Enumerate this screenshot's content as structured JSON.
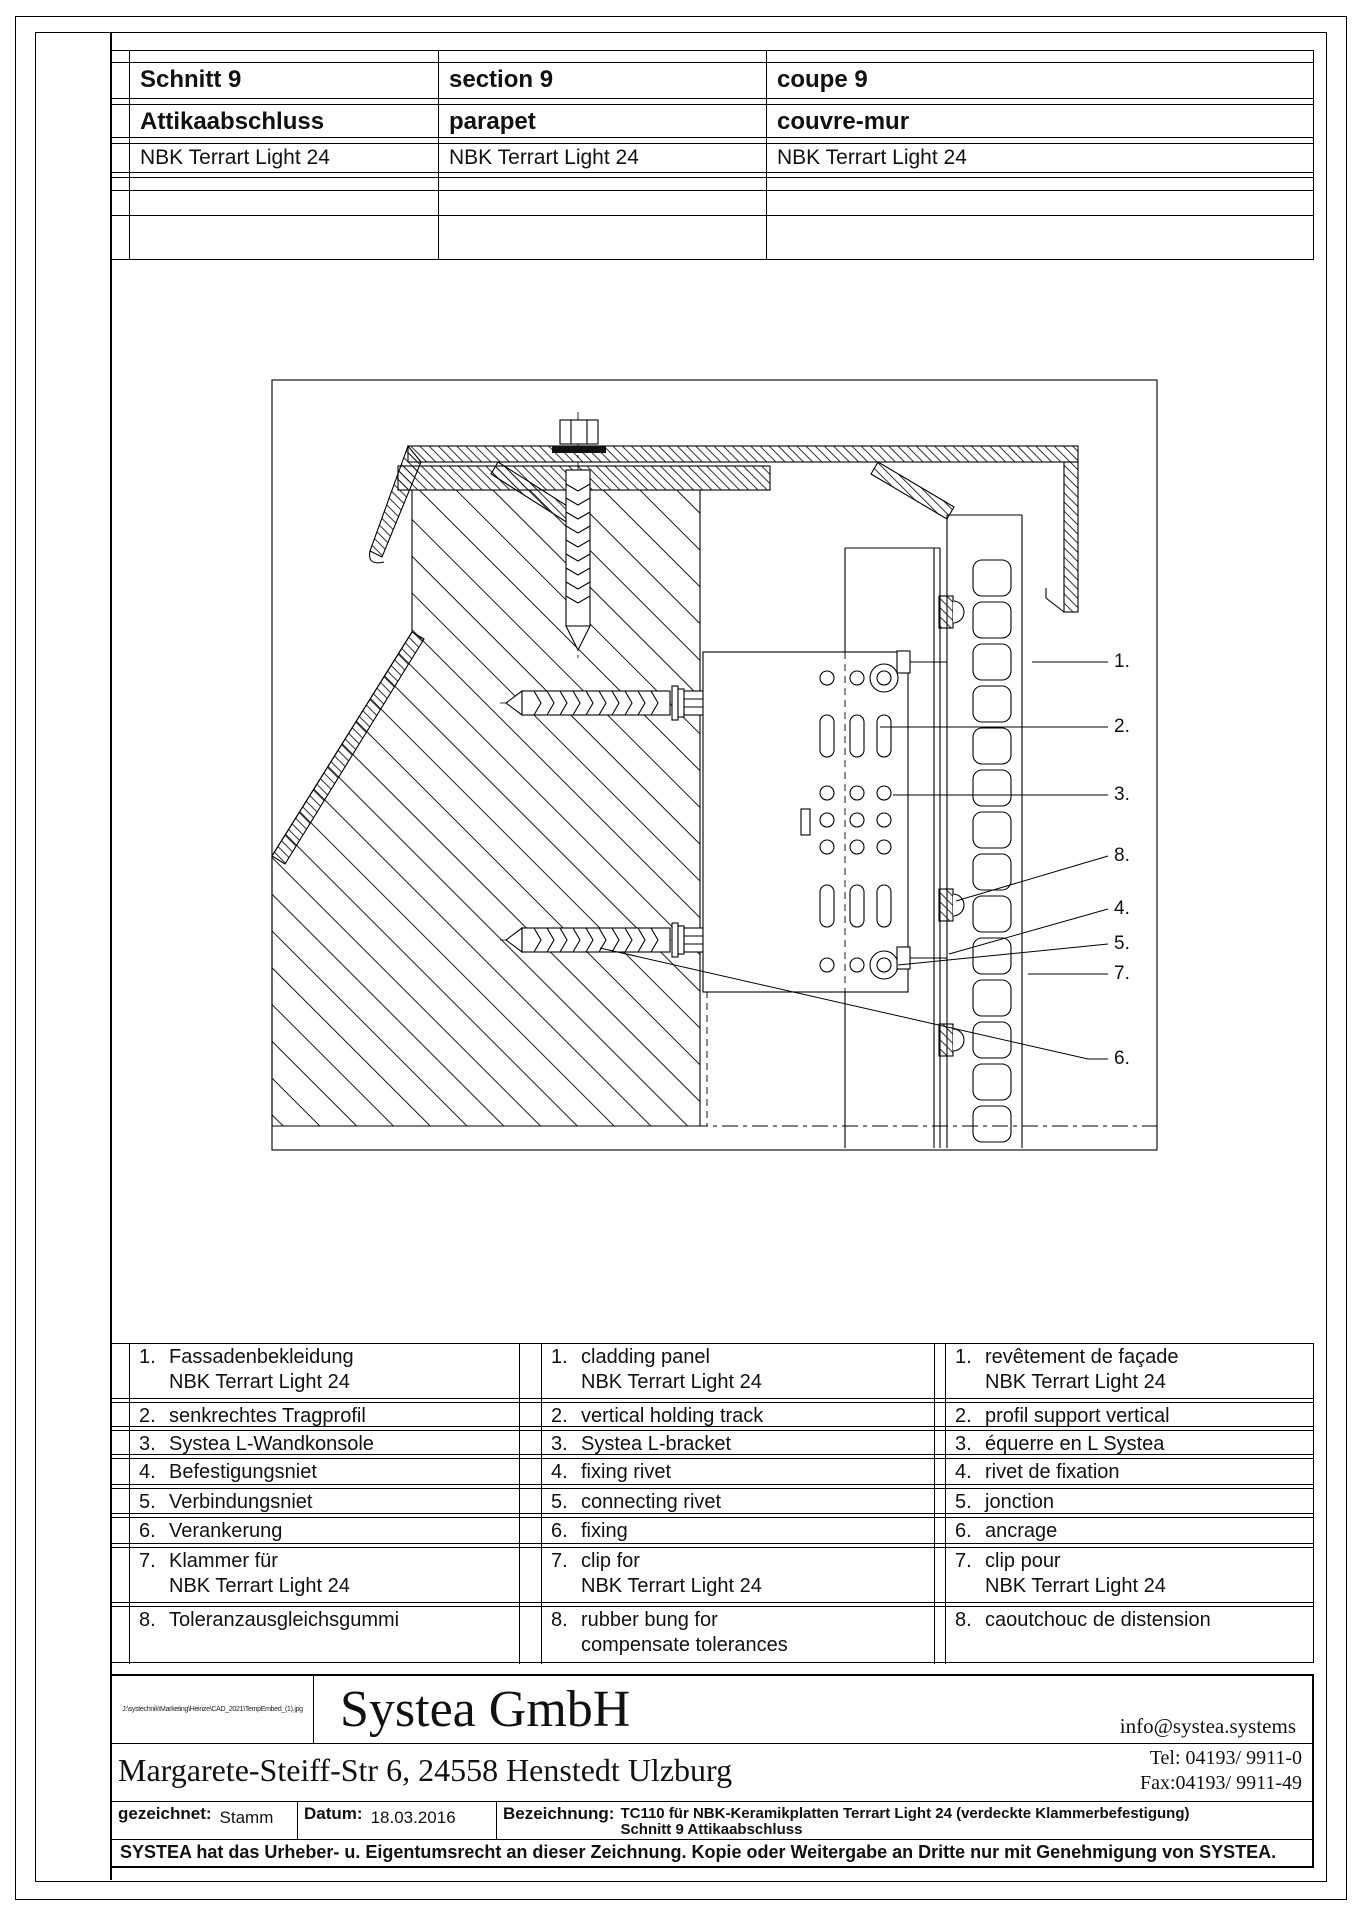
{
  "header_table": {
    "rows": [
      {
        "de": "Schnitt 9",
        "en": "section 9",
        "fr": "coupe 9"
      },
      {
        "de": "Attikaabschluss",
        "en": "parapet",
        "fr": "couvre-mur"
      },
      {
        "de": "NBK Terrart Light 24",
        "en": "NBK Terrart Light 24",
        "fr": "NBK Terrart Light 24"
      }
    ]
  },
  "callouts": [
    "1.",
    "2.",
    "3.",
    "8.",
    "4.",
    "5.",
    "7.",
    "6."
  ],
  "legend": {
    "rows": [
      {
        "num": "1.",
        "de": [
          "Fassadenbekleidung",
          "NBK Terrart Light 24"
        ],
        "en": [
          "cladding panel",
          "NBK Terrart Light 24"
        ],
        "fr": [
          "revêtement de façade",
          "NBK Terrart Light 24"
        ]
      },
      {
        "num": "2.",
        "de": [
          "senkrechtes Tragprofil"
        ],
        "en": [
          "vertical holding track"
        ],
        "fr": [
          "profil support vertical"
        ]
      },
      {
        "num": "3.",
        "de": [
          "Systea L-Wandkonsole"
        ],
        "en": [
          "Systea L-bracket"
        ],
        "fr": [
          "équerre en L Systea"
        ]
      },
      {
        "num": "4.",
        "de": [
          "Befestigungsniet"
        ],
        "en": [
          "fixing rivet"
        ],
        "fr": [
          "rivet de fixation"
        ]
      },
      {
        "num": "5.",
        "de": [
          "Verbindungsniet"
        ],
        "en": [
          "connecting rivet"
        ],
        "fr": [
          "jonction"
        ]
      },
      {
        "num": "6.",
        "de": [
          "Verankerung"
        ],
        "en": [
          "fixing"
        ],
        "fr": [
          "ancrage"
        ]
      },
      {
        "num": "7.",
        "de": [
          "Klammer für",
          "NBK Terrart Light 24"
        ],
        "en": [
          "clip for",
          "NBK Terrart Light 24"
        ],
        "fr": [
          "clip pour",
          "NBK Terrart Light 24"
        ]
      },
      {
        "num": "8.",
        "de": [
          "Toleranzausgleichsgummi"
        ],
        "en": [
          "rubber bung for",
          "compensate tolerances"
        ],
        "fr": [
          "caoutchouc de distension"
        ]
      }
    ]
  },
  "title_block": {
    "file_path": "J:\\systechnik\\Marketing\\Heinze\\CAD_2021\\TempEmbed_(1).jpg",
    "company": "Systea GmbH",
    "address": "Margarete-Steiff-Str 6, 24558 Henstedt Ulzburg",
    "email": "info@systea.systems",
    "tel": "Tel: 04193/ 9911-0",
    "fax": "Fax:04193/ 9911-49",
    "drawn_label": "gezeichnet:",
    "drawn_value": "Stamm",
    "date_label": "Datum:",
    "date_value": "18.03.2016",
    "designation_label": "Bezeichnung:",
    "designation_line1": "TC110 für NBK-Keramikplatten Terrart Light 24 (verdeckte Klammerbefestigung)",
    "designation_line2": "Schnitt 9 Attikaabschluss",
    "copyright": "SYSTEA hat das Urheber- u. Eigentumsrecht an dieser Zeichnung. Kopie oder Weitergabe an Dritte nur mit Genehmigung von SYSTEA."
  }
}
